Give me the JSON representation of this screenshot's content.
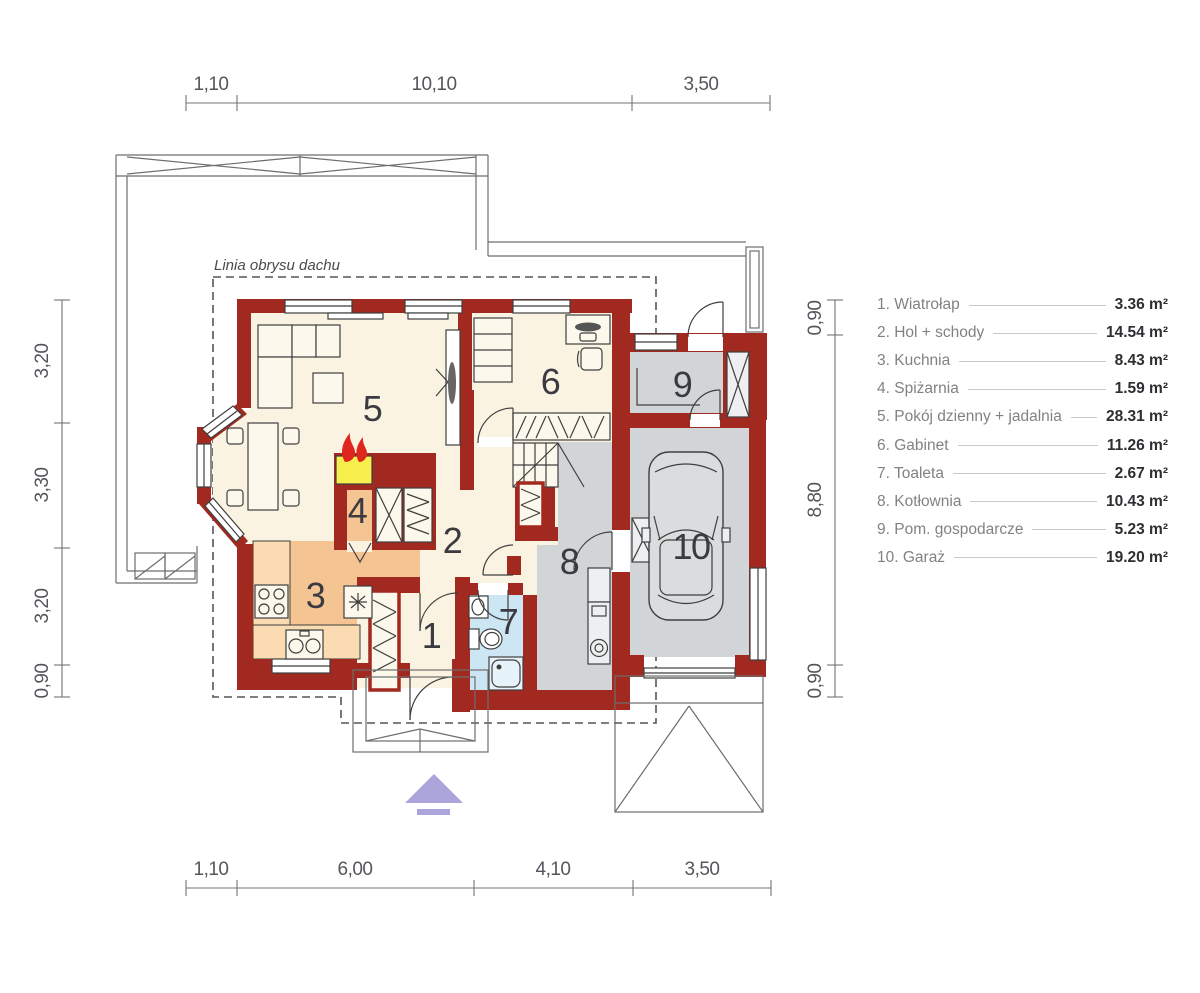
{
  "roof_outline_label": "Linia obrysu dachu",
  "dimensions": {
    "top": [
      "1,10",
      "10,10",
      "3,50"
    ],
    "bottom": [
      "1,10",
      "6,00",
      "4,10",
      "3,50"
    ],
    "left": [
      "3,20",
      "3,30",
      "3,20",
      "0,90"
    ],
    "right": [
      "0,90",
      "8,80",
      "0,90"
    ]
  },
  "rooms": [
    {
      "number": "1",
      "label": "1. Wiatrołap",
      "area": "3.36 m²"
    },
    {
      "number": "2",
      "label": "2. Hol + schody",
      "area": "14.54 m²"
    },
    {
      "number": "3",
      "label": "3. Kuchnia",
      "area": "8.43 m²"
    },
    {
      "number": "4",
      "label": "4. Spiżarnia",
      "area": "1.59 m²"
    },
    {
      "number": "5",
      "label": "5. Pokój dzienny + jadalnia",
      "area": "28.31 m²"
    },
    {
      "number": "6",
      "label": "6. Gabinet",
      "area": "11.26 m²"
    },
    {
      "number": "7",
      "label": "7. Toaleta",
      "area": "2.67 m²"
    },
    {
      "number": "8",
      "label": "8. Kotłownia",
      "area": "10.43 m²"
    },
    {
      "number": "9",
      "label": "9. Pom. gospodarcze",
      "area": "5.23 m²"
    },
    {
      "number": "10",
      "label": "10. Garaż",
      "area": "19.20 m²"
    }
  ],
  "colors": {
    "wall": "#A1291F",
    "floor_main": "#FAF3E2",
    "floor_kitchen": "#F5C493",
    "kitchen_counter": "#FBDCB2",
    "floor_gray": "#D2D5D7",
    "floor_bath": "#CDE6F3",
    "fireplace_yellow": "#F8EE4E",
    "flame_red": "#E0251C",
    "entrance_arrow": "#ABA5DB"
  }
}
